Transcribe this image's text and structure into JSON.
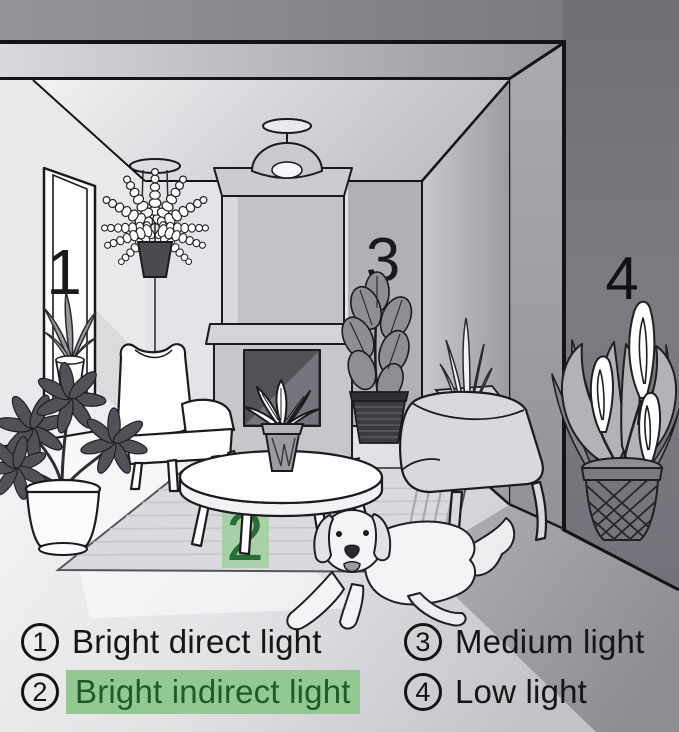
{
  "scene": {
    "markers": {
      "window": "1",
      "rug": "2",
      "fireplace_wall": "3",
      "dark_wall": "4"
    }
  },
  "legend": {
    "items": [
      {
        "number": "1",
        "label": "Bright direct light",
        "highlighted": false
      },
      {
        "number": "2",
        "label": "Bright indirect light",
        "highlighted": true
      },
      {
        "number": "3",
        "label": "Medium light",
        "highlighted": false
      },
      {
        "number": "4",
        "label": "Low light",
        "highlighted": false
      }
    ]
  },
  "colors": {
    "marker_badge_bg": "#a3cfa3",
    "marker_badge_text": "#2b6b35",
    "legend_highlight_bg": "#93c893",
    "legend_highlight_text": "#1d5c2a"
  }
}
